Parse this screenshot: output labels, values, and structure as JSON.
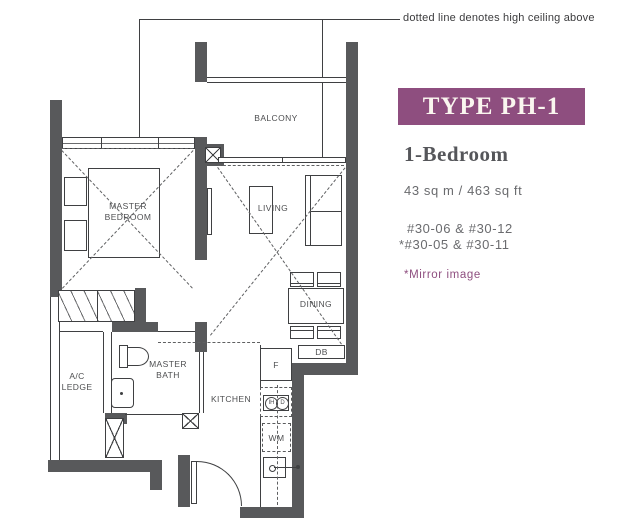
{
  "annotation": {
    "text": "dotted line denotes high ceiling above"
  },
  "plan": {
    "rooms": {
      "balcony": "BALCONY",
      "living": "LIVING",
      "dining": "DINING",
      "master_bedroom_line1": "MASTER",
      "master_bedroom_line2": "BEDROOM",
      "master_bath_line1": "MASTER",
      "master_bath_line2": "BATH",
      "kitchen": "KITCHEN",
      "ac_ledge_line1": "A/C",
      "ac_ledge_line2": "LEDGE"
    },
    "fixtures": {
      "fridge": "F",
      "washer": "WM",
      "db": "DB",
      "hob_zone1": "IH",
      "hob_zone2": "D"
    }
  },
  "panel": {
    "type_label": "TYPE PH-1",
    "bedroom_label": "1-Bedroom",
    "area_label": "43 sq m / 463 sq ft",
    "units_line1": "#30-06 & #30-12",
    "units_line2": "*#30-05 & #30-11",
    "mirror_note": "*Mirror image"
  },
  "colors": {
    "accent_purple": "#8e4e7f",
    "wall_gray": "#58595b",
    "text_gray": "#6a6b6e"
  }
}
